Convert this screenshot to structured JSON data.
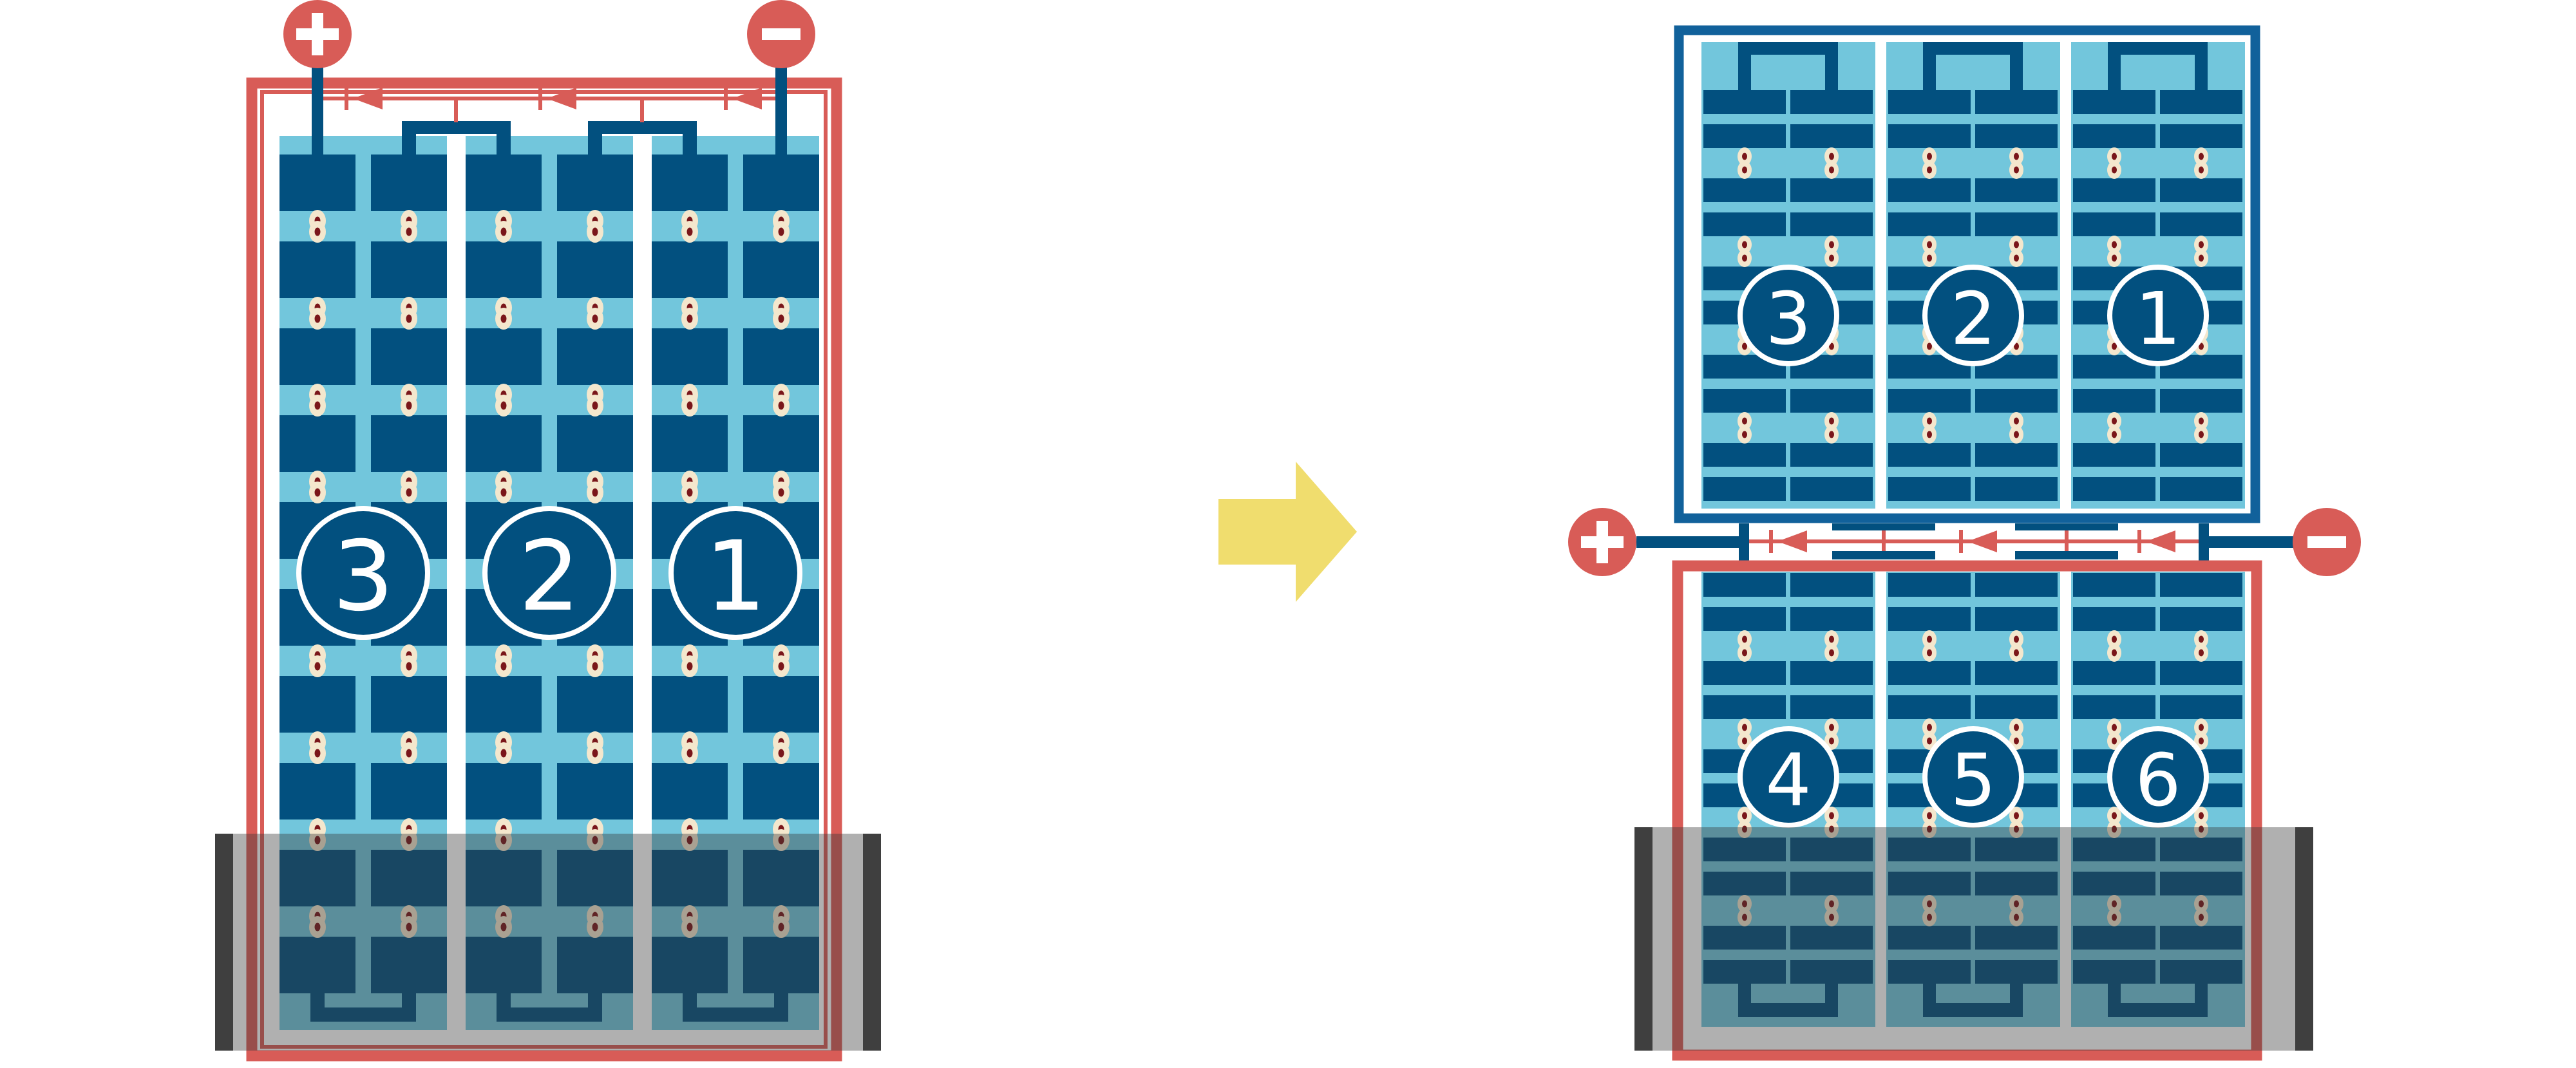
{
  "diagram": {
    "description": "full-cell solar module transformed into half-cut cell solar module",
    "colors": {
      "background": "#FFFFFF",
      "red": "#D85C57",
      "dark_red": "#7A161A",
      "cream": "#F4E7CD",
      "cell_blue": "#02507F",
      "light_blue": "#72C6DC",
      "frame_blue": "#11619B",
      "shade_band": "rgba(58,58,58,0.40)",
      "shade_post": "rgba(35,35,35,0.80)",
      "arrow_yellow": "#F0DD6E",
      "number_text": "#FFFFFF"
    },
    "left_module": {
      "frame_color_key": "red",
      "terminals": {
        "positive": "+",
        "negative": "−"
      },
      "strings": [
        {
          "label": "3"
        },
        {
          "label": "2"
        },
        {
          "label": "1"
        }
      ],
      "cell_rows": 10,
      "columns_per_string": 2,
      "bypass_diodes": 3,
      "shade": {
        "present": true,
        "covers_bottom_rows": 2
      }
    },
    "arrow": {
      "direction": "right"
    },
    "right_top_module": {
      "frame_color_key": "frame_blue",
      "strings": [
        {
          "label": "3"
        },
        {
          "label": "2"
        },
        {
          "label": "1"
        }
      ],
      "cell_rows": 10,
      "columns_per_string": 2
    },
    "junction": {
      "terminals": {
        "positive": "+",
        "negative": "−"
      },
      "bypass_diodes": 3
    },
    "right_bottom_module": {
      "frame_color_key": "red",
      "strings": [
        {
          "label": "4"
        },
        {
          "label": "5"
        },
        {
          "label": "6"
        }
      ],
      "cell_rows": 10,
      "columns_per_string": 2,
      "shade": {
        "present": true,
        "covers_bottom_rows": 3
      }
    }
  }
}
